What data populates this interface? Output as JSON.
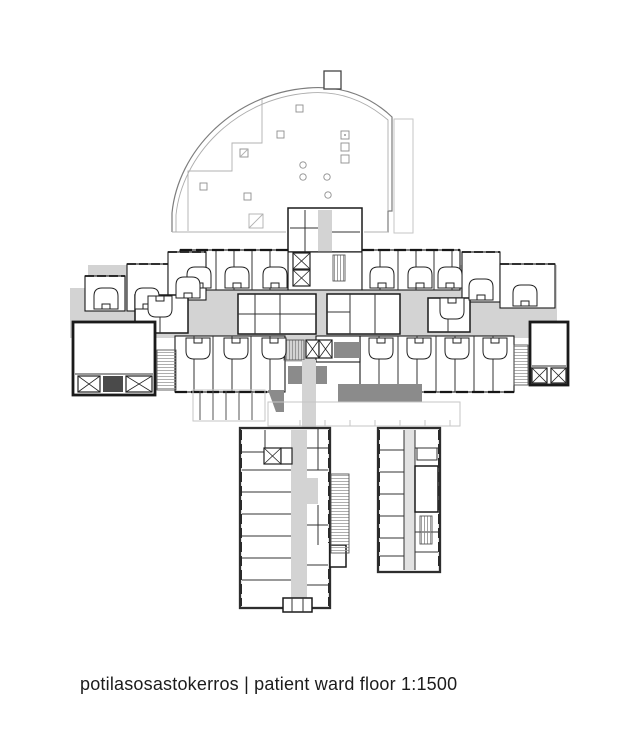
{
  "caption": {
    "full": "potilasosastokerros | patient ward floor 1:1500",
    "label_fi": "potilasosastokerros",
    "label_en": "patient ward floor",
    "scale": "1:1500"
  },
  "colors": {
    "wall": "#1a1a1a",
    "corridor": "#d3d3d3",
    "shadow": "#8b8b8b",
    "faint": "#c6c6c6",
    "background": "#ffffff"
  },
  "plan": {
    "drawing_type": "architectural floor plan",
    "areas": {
      "fan_roof": "fan-shaped auditorium roof outline (top)",
      "ward_wing": "horizontal patient ward wing with gray corridors and patient beds",
      "south_west_wing": "lower left wing with central corridor",
      "south_east_wing": "lower right wing",
      "ramp": "hatched stair/ramp between lower wings"
    }
  }
}
